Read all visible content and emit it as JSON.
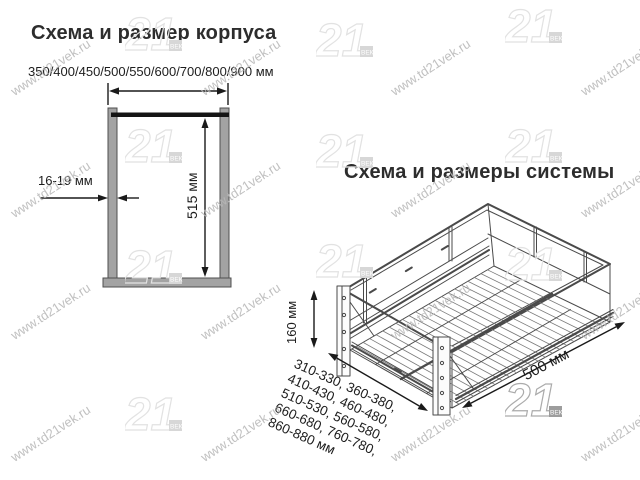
{
  "left_diagram": {
    "title": "Схема и размер корпуса",
    "width_options": "350/400/450/500/550/600/700/800/900 мм",
    "height_label": "515 мм",
    "thickness_label": "16-19 мм"
  },
  "right_diagram": {
    "title": "Схема и размеры системы",
    "height_label": "160 мм",
    "depth_label": "500 мм",
    "width_lines": [
      "310-330, 360-380,",
      "410-430, 460-480,",
      "510-530, 560-580,",
      "660-680, 760-780,",
      "860-880 мм"
    ]
  },
  "watermark": {
    "text": "www.td21vek.ru",
    "logo_text": "21",
    "logo_sub": "ВЕК"
  },
  "colors": {
    "background": "#ffffff",
    "text": "#2d2d2d",
    "dimension_lines": "#1a1a1a",
    "drawing_lines": "#4a4a4a",
    "wall_gray": "#a3a3a3",
    "watermark_gray": "#b8b8b8",
    "logo_gray": "#e2e2e2"
  }
}
